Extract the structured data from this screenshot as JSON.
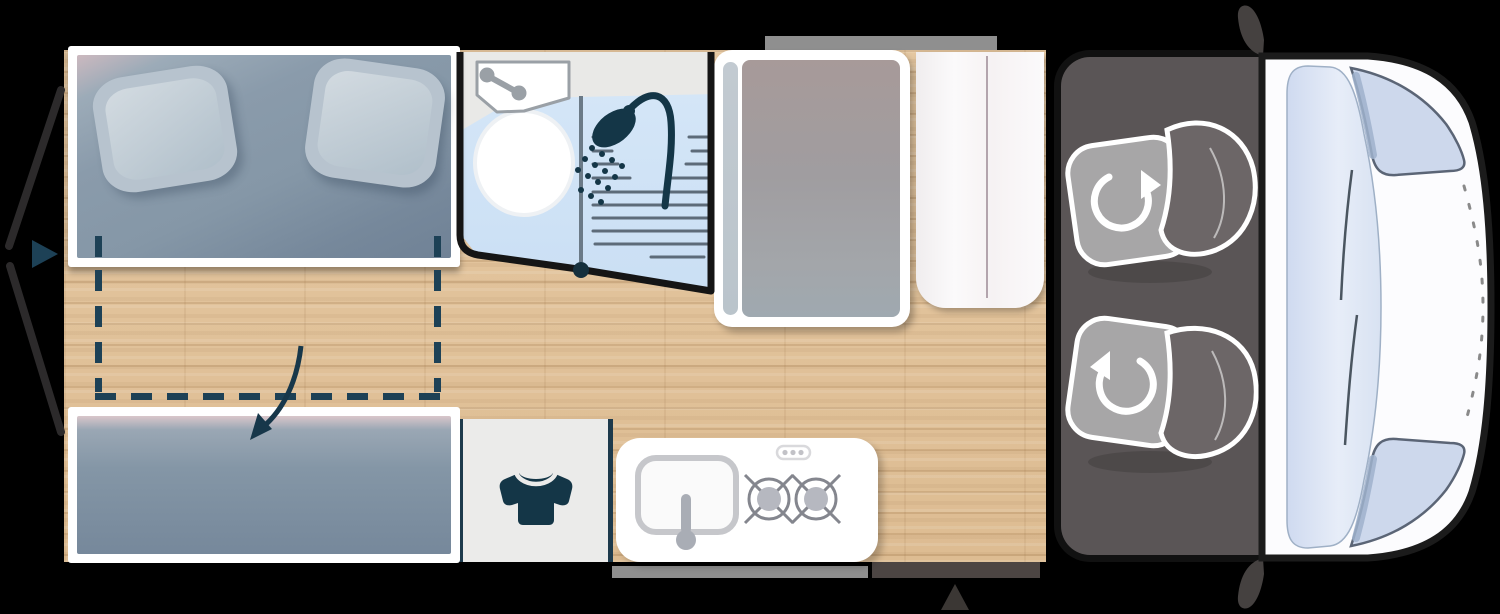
{
  "meta": {
    "scene": "campervan-floorplan-top-view",
    "canvas-width": 1500,
    "canvas-height": 614
  },
  "colors": {
    "bg": "#000000",
    "wood": "#e5c8a2",
    "wood-seam": "#c9a87e",
    "frame-white": "#ffffff",
    "mattress": "#8597a7",
    "mattress-pink": "#ccb9bf",
    "pillow": "#b7c3ce",
    "pillow-inner": "#d3dbe1",
    "dash-teal": "#1d4156",
    "arrow-navy": "#17374a",
    "bath-blue": "#cadff4",
    "bath-counter": "#e9e9e7",
    "fixture-gray": "#9aa0a6",
    "drain-gray": "#5d6b79",
    "icon-navy": "#143647",
    "boundary-black": "#151515",
    "dot-navy": "#16303d",
    "wardrobe-gray": "#a19d9f",
    "wardrobe-pill": "#bac4cb",
    "fridge-white": "#fbfafb",
    "fridge-line": "#b3a4ad",
    "closet-gray": "#ebebea",
    "closet-line": "#1d3a4c",
    "kitchen-white": "#ffffff",
    "kitchen-line": "#c6c7cb",
    "burner-gray": "#84868e",
    "burner-disc": "#b6b8c0",
    "faucet-gray": "#a9adb5",
    "cab-floor": "#5a5556",
    "seat-cushion": "#a7a6a7",
    "seat-back": "#6c6667",
    "body-white": "#fcfcfe",
    "outline-black": "#1b1b1b",
    "windshield-blue": "#d8e2f2",
    "corner-window": "#cdd8ec",
    "window-streak": "#9fb2cd",
    "window-outline": "#5b6576",
    "wiper-gray": "#4a5560",
    "hood-dash": "#8a8a8a",
    "mirror-gray": "#454140",
    "window-bar": "#8f8f8f",
    "door-bar": "#4c4543",
    "floor-triangle": "#3b3734",
    "rear-door-line": "#2c2a2b"
  },
  "icons": [
    "rotate-cw-icon",
    "rotate-ccw-icon",
    "shower-icon",
    "tshirt-icon",
    "sink-icon",
    "faucet-icon",
    "toilet-icon",
    "burner-icon",
    "entry-arrow-icon",
    "fold-down-arrow-icon",
    "mirror-icon",
    "wiper-icon"
  ],
  "regions": [
    "rear-bed",
    "fold-down-bed-area",
    "bench-seat",
    "bathroom",
    "shower",
    "wardrobe",
    "fridge",
    "closet",
    "kitchen-block",
    "cab",
    "passenger-seat",
    "driver-seat",
    "van-front",
    "rear-doors",
    "side-entry",
    "window-top",
    "window-bottom",
    "sliding-door"
  ]
}
